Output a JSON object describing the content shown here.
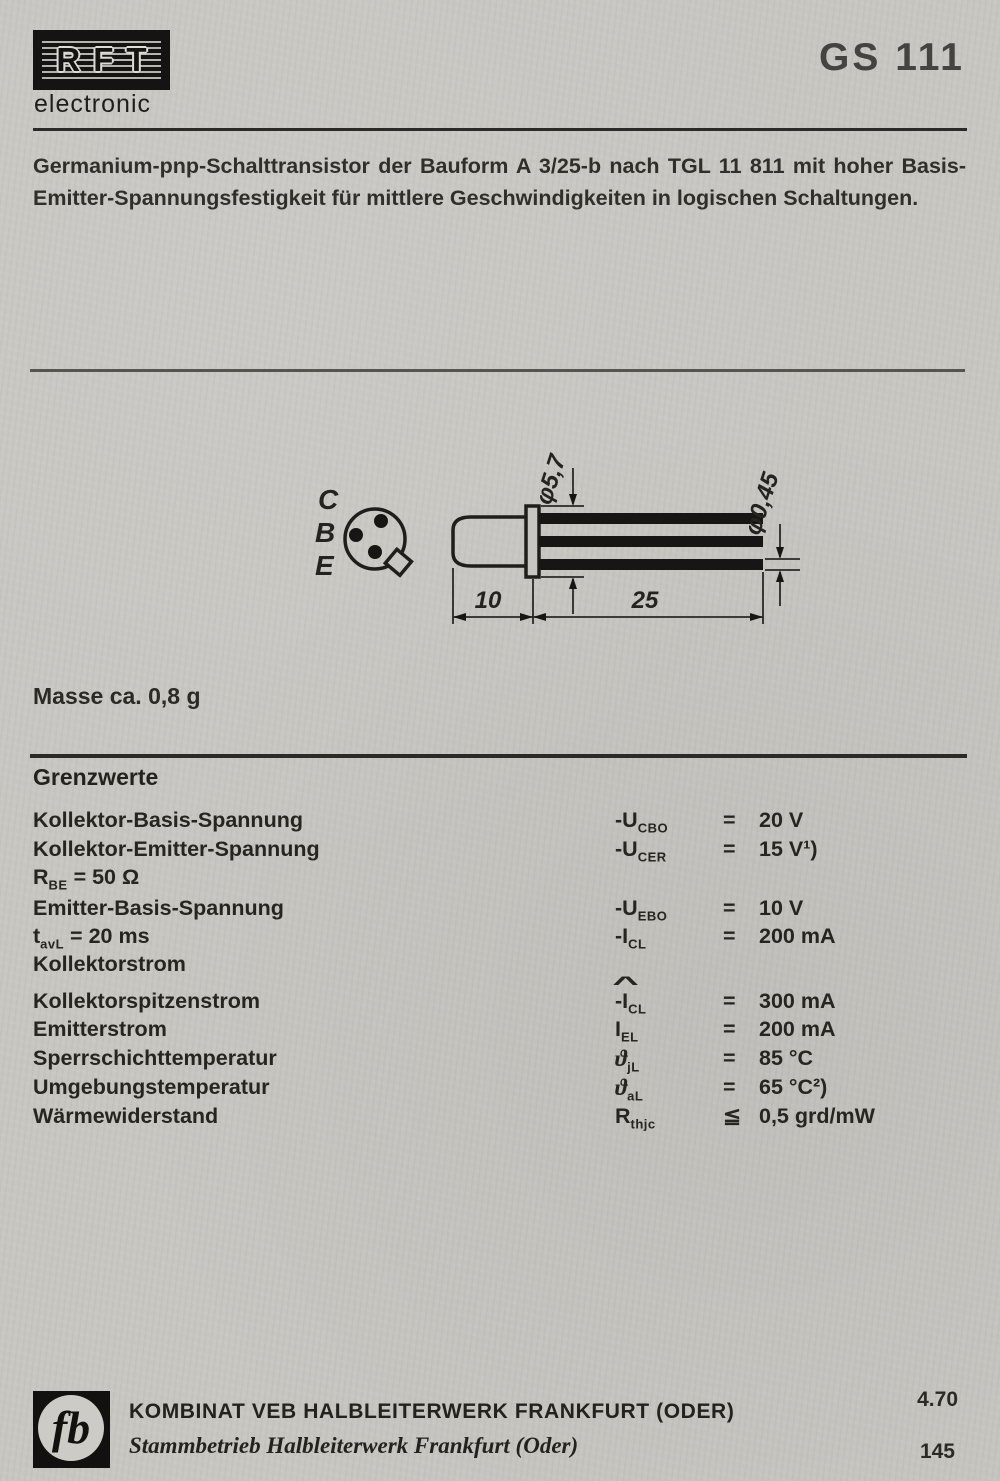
{
  "header": {
    "logo_text": "RFT",
    "logo_subtext": "electronic",
    "part_number": "GS 111"
  },
  "description": {
    "line1": "Germanium-pnp-Schalttransistor der Bauform A 3/25-b nach TGL 11 811 mit hoher Basis-",
    "line2": "Emitter-Spannungsfestigkeit für mittlere Geschwindigkeiten in logischen Schaltungen."
  },
  "drawing": {
    "pin_labels": [
      "C",
      "B",
      "E"
    ],
    "dim_flange_diameter": "φ5,7",
    "dim_lead_diameter": "φ0,45",
    "dim_body_length": "10",
    "dim_lead_length": "25"
  },
  "mass_note": "Masse ca. 0,8 g",
  "limits": {
    "title": "Grenzwerte",
    "rows": [
      {
        "label": "Kollektor-Basis-Spannung",
        "sym_pre": "-U",
        "sym_sub": "CBO",
        "rel": "=",
        "value": "20 V"
      },
      {
        "label": "Kollektor-Emitter-Spannung",
        "sym_pre": "-U",
        "sym_sub": "CER",
        "rel": "=",
        "value": "15 V¹)"
      },
      {
        "label_pre": "R",
        "label_sub": "BE",
        "label_post": " = 50 Ω"
      },
      {
        "label": "Emitter-Basis-Spannung",
        "sym_pre": "-U",
        "sym_sub": "EBO",
        "rel": "=",
        "value": "10 V"
      },
      {
        "label_pre": "t",
        "label_sub": "avL",
        "label_post": " = 20 ms",
        "sym_pre": "-I",
        "sym_sub": "CL",
        "rel": "=",
        "value": "200 mA"
      },
      {
        "label": "Kollektorstrom"
      },
      {
        "label": "Kollektorspitzenstrom",
        "sym_hat": "^",
        "sym_pre": "-I",
        "sym_sub": "CL",
        "rel": "=",
        "value": "300 mA"
      },
      {
        "label": "Emitterstrom",
        "sym_pre": "I",
        "sym_sub": "EL",
        "rel": "=",
        "value": "200 mA"
      },
      {
        "label": "Sperrschichttemperatur",
        "sym_pre": "ϑ",
        "sym_sub": "jL",
        "rel": "=",
        "value": "85 °C"
      },
      {
        "label": "Umgebungstemperatur",
        "sym_pre": "ϑ",
        "sym_sub": "aL",
        "rel": "=",
        "value": "65 °C²)"
      },
      {
        "label": "Wärmewiderstand",
        "sym_pre": "R",
        "sym_sub": "thjc",
        "rel": "≦",
        "value": "0,5 grd/mW"
      }
    ]
  },
  "footer": {
    "logo_glyph": "fb",
    "company_line1": "KOMBINAT VEB HALBLEITERWERK FRANKFURT (ODER)",
    "company_line2": "Stammbetrieb Halbleiterwerk Frankfurt (Oder)",
    "edition": "4.70",
    "page_number": "145"
  }
}
